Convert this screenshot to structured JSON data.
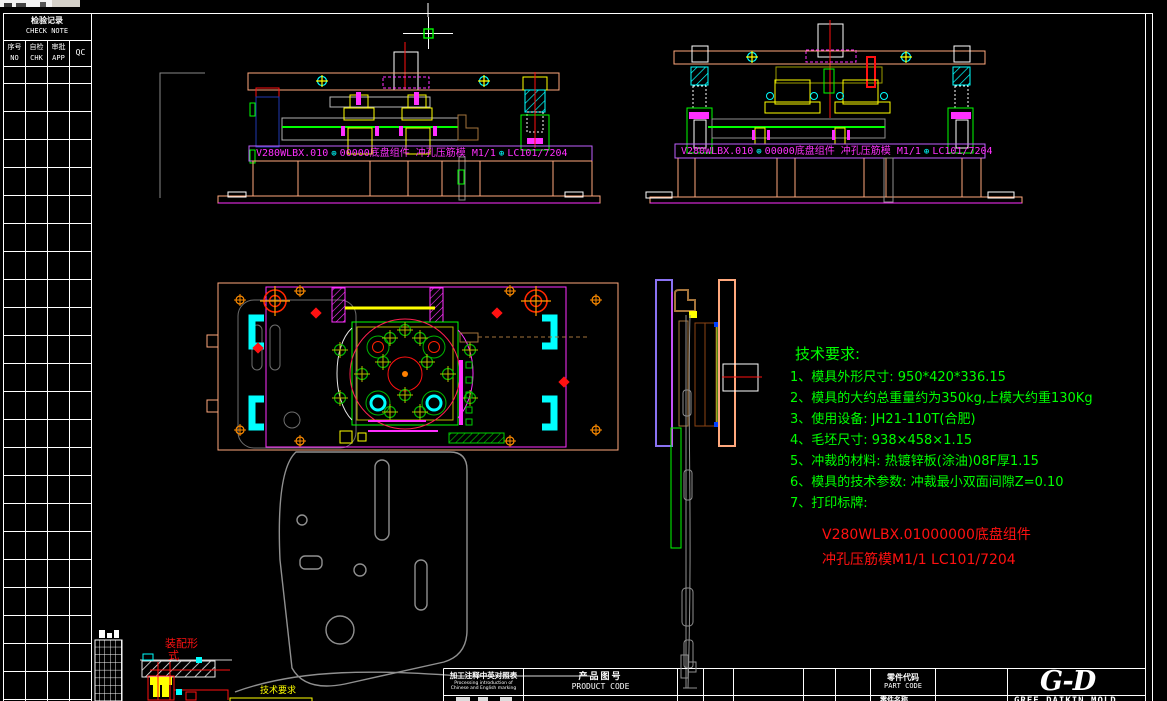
{
  "check_table": {
    "title_cn": "检验记录",
    "title_en": "CHECK NOTE",
    "col1_cn": "序号",
    "col1_en": "NO",
    "col2_cn": "自检",
    "col2_en": "CHK",
    "col3_cn": "审批",
    "col3_en": "APP",
    "col4": "QC"
  },
  "nameplate": {
    "code": "V280WLBX.010",
    "datum": "⊕",
    "assembly": "00000底盘组件 冲孔压筋模 M1/1",
    "tail": "LC101/7204"
  },
  "tech_requirements": {
    "title": "技术要求:",
    "items": [
      "1、模具外形尺寸: 950*420*336.15",
      "2、模具的大约总重量约为350kg,上模大约重130Kg",
      "3、使用设备: JH21-110T(合肥)",
      "4、毛坯尺寸: 938×458×1.15",
      "5、冲裁的材料: 热镀锌板(涂油)08F厚1.15",
      "6、模具的技术参数: 冲裁最小双面间隙Z=0.10",
      "7、打印标牌:"
    ],
    "plate_line1": "V280WLBX.01000000底盘组件",
    "plate_line2": "冲孔压筋模M1/1  LC101/7204"
  },
  "annotations": {
    "assembly_form_l1": "装配形",
    "assembly_form_l2": "式",
    "tech_req_label": "技术要求"
  },
  "title_block": {
    "box1_cn": "加工注释中英对照表",
    "box1_en1": "Processing introduction of",
    "box1_en2": "Chinese and English marking",
    "product_code_cn": "产品图号",
    "product_code_en": "PRODUCT CODE",
    "part_code_cn": "零件代码",
    "part_code_en": "PART CODE",
    "part_name_cn": "零件名称",
    "logo": "G-D",
    "logo_sub": "GREE DAIKIN MOLD"
  },
  "colors": {
    "background": "#000000",
    "frame": "#ffffff",
    "tech_text": "#00ff00",
    "plate_text": "#ff1111",
    "nameplate_text": "#ff30ff",
    "plate_outline": "#ffa87d",
    "spring": "#00ffff",
    "guide": "#ffff00"
  }
}
